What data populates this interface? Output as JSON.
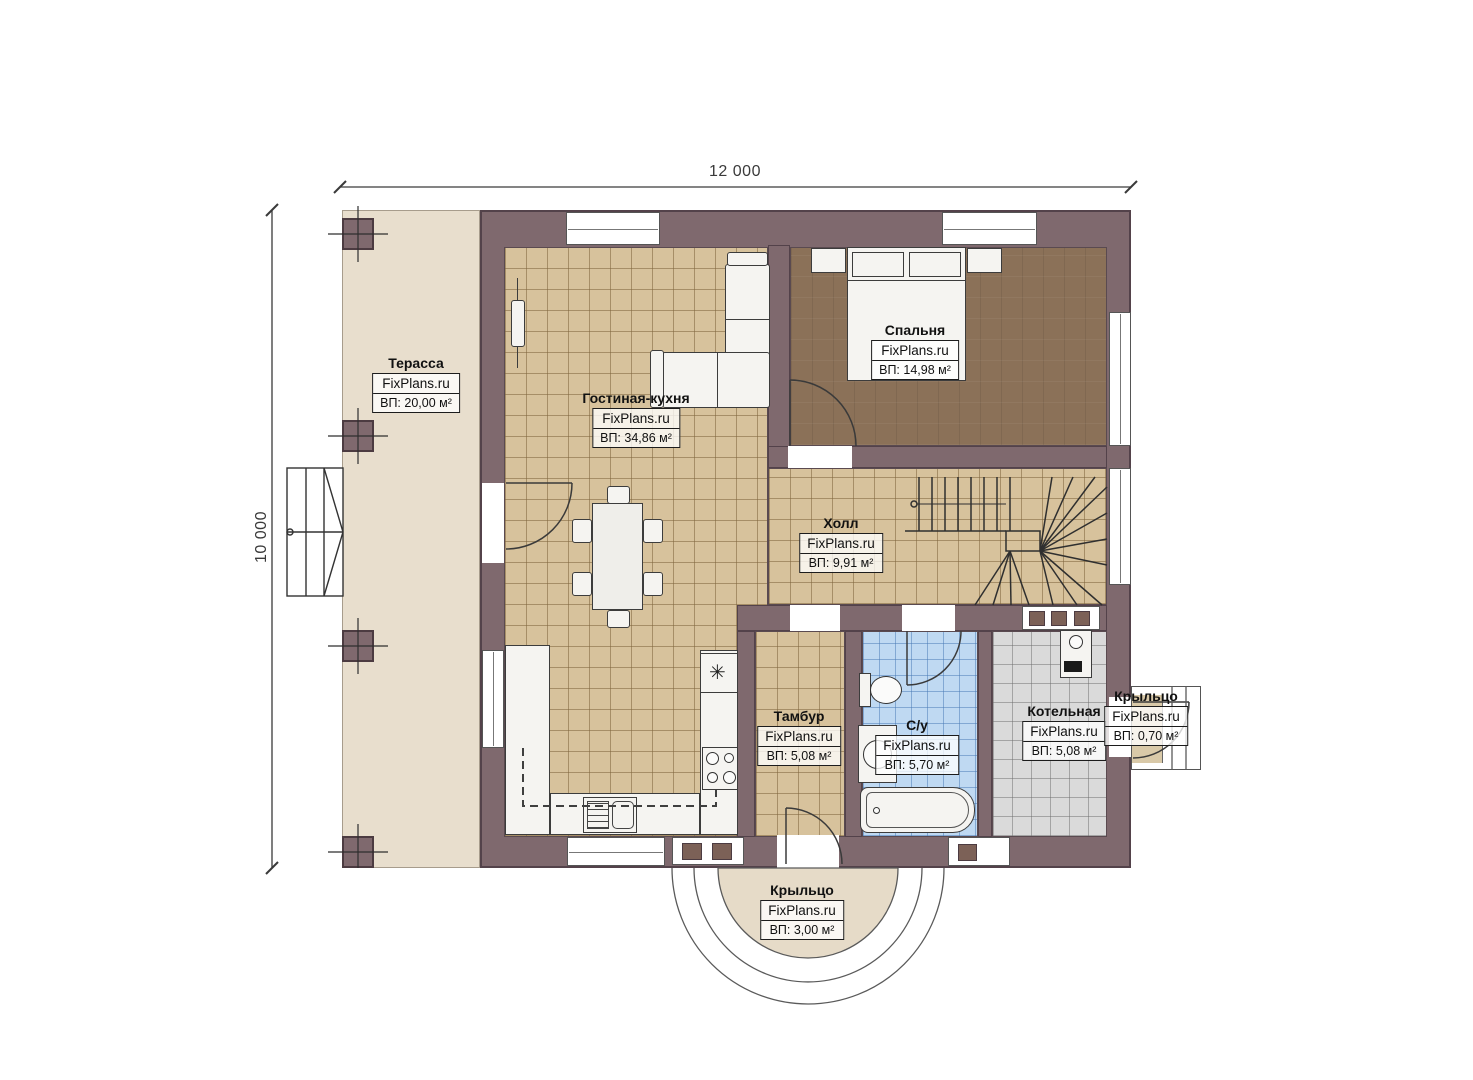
{
  "brand": "FixPlans.ru",
  "dimensions": {
    "width_label": "12 000",
    "height_label": "10 000"
  },
  "rooms": {
    "terrace": {
      "name": "Терасса",
      "area": "ВП: 20,00 м²"
    },
    "living": {
      "name": "Гостиная-кухня",
      "area": "ВП: 34,86 м²"
    },
    "bedroom": {
      "name": "Спальня",
      "area": "ВП: 14,98 м²"
    },
    "hall": {
      "name": "Холл",
      "area": "ВП: 9,91 м²"
    },
    "tambour": {
      "name": "Тамбур",
      "area": "ВП: 5,08 м²"
    },
    "bathroom": {
      "name": "С/у",
      "area": "ВП: 5,70 м²"
    },
    "boiler": {
      "name": "Котельная",
      "area": "ВП: 5,08 м²"
    },
    "porch_right": {
      "name": "Крыльцо",
      "area": "ВП: 0,70 м²"
    },
    "porch_bottom": {
      "name": "Крыльцо",
      "area": "ВП: 3,00 м²"
    }
  },
  "symbols": {
    "vent": "✳"
  },
  "palette": {
    "wall": "#7f696e",
    "wall_outline": "#53424a",
    "floor_tile": "#d7c29c",
    "terrace": "#e8decd",
    "bedroom_floor": "#8b7158",
    "bathroom_tile": "#bfd9f2",
    "boiler_tile": "#d9d9d9",
    "porch": "#e6dbc8",
    "fixture": "#f5f4f1"
  }
}
